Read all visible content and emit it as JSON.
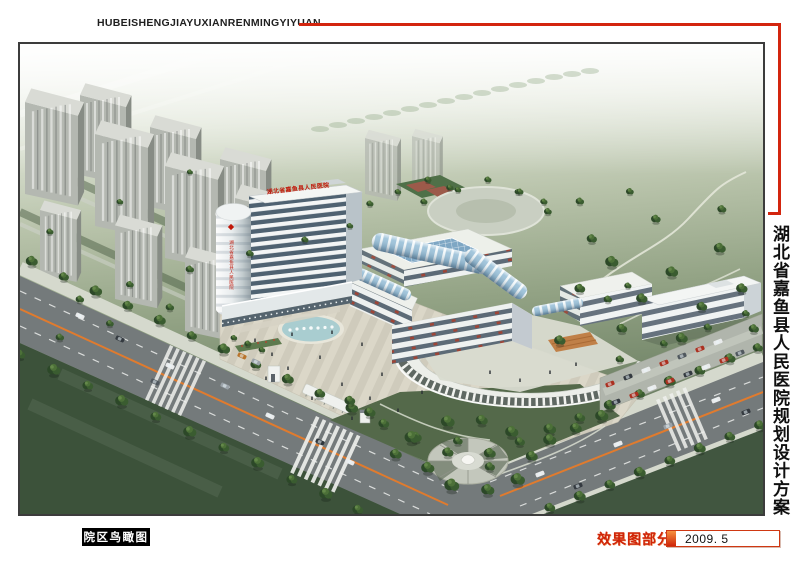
{
  "header": {
    "pinyin_title": "HUBEISHENGJIAYUXIANRENMINGYIYUAN"
  },
  "side_title": {
    "text": "湖北省嘉鱼县人民医院规划设计方案"
  },
  "footer": {
    "view_label": "院区鸟瞰图",
    "section_label": "效果图部分",
    "date": "2009. 5"
  },
  "scene": {
    "tower_roof_sign": "湖北省嘉鱼县人民医院",
    "tower_side_sign": "湖北省嘉鱼县人民医院"
  },
  "palette": {
    "accent_red": "#d3250e",
    "sign_red": "#c11708",
    "view_label_bg": "#000000",
    "view_label_text": "#ffffff",
    "date_text": "#111111"
  }
}
